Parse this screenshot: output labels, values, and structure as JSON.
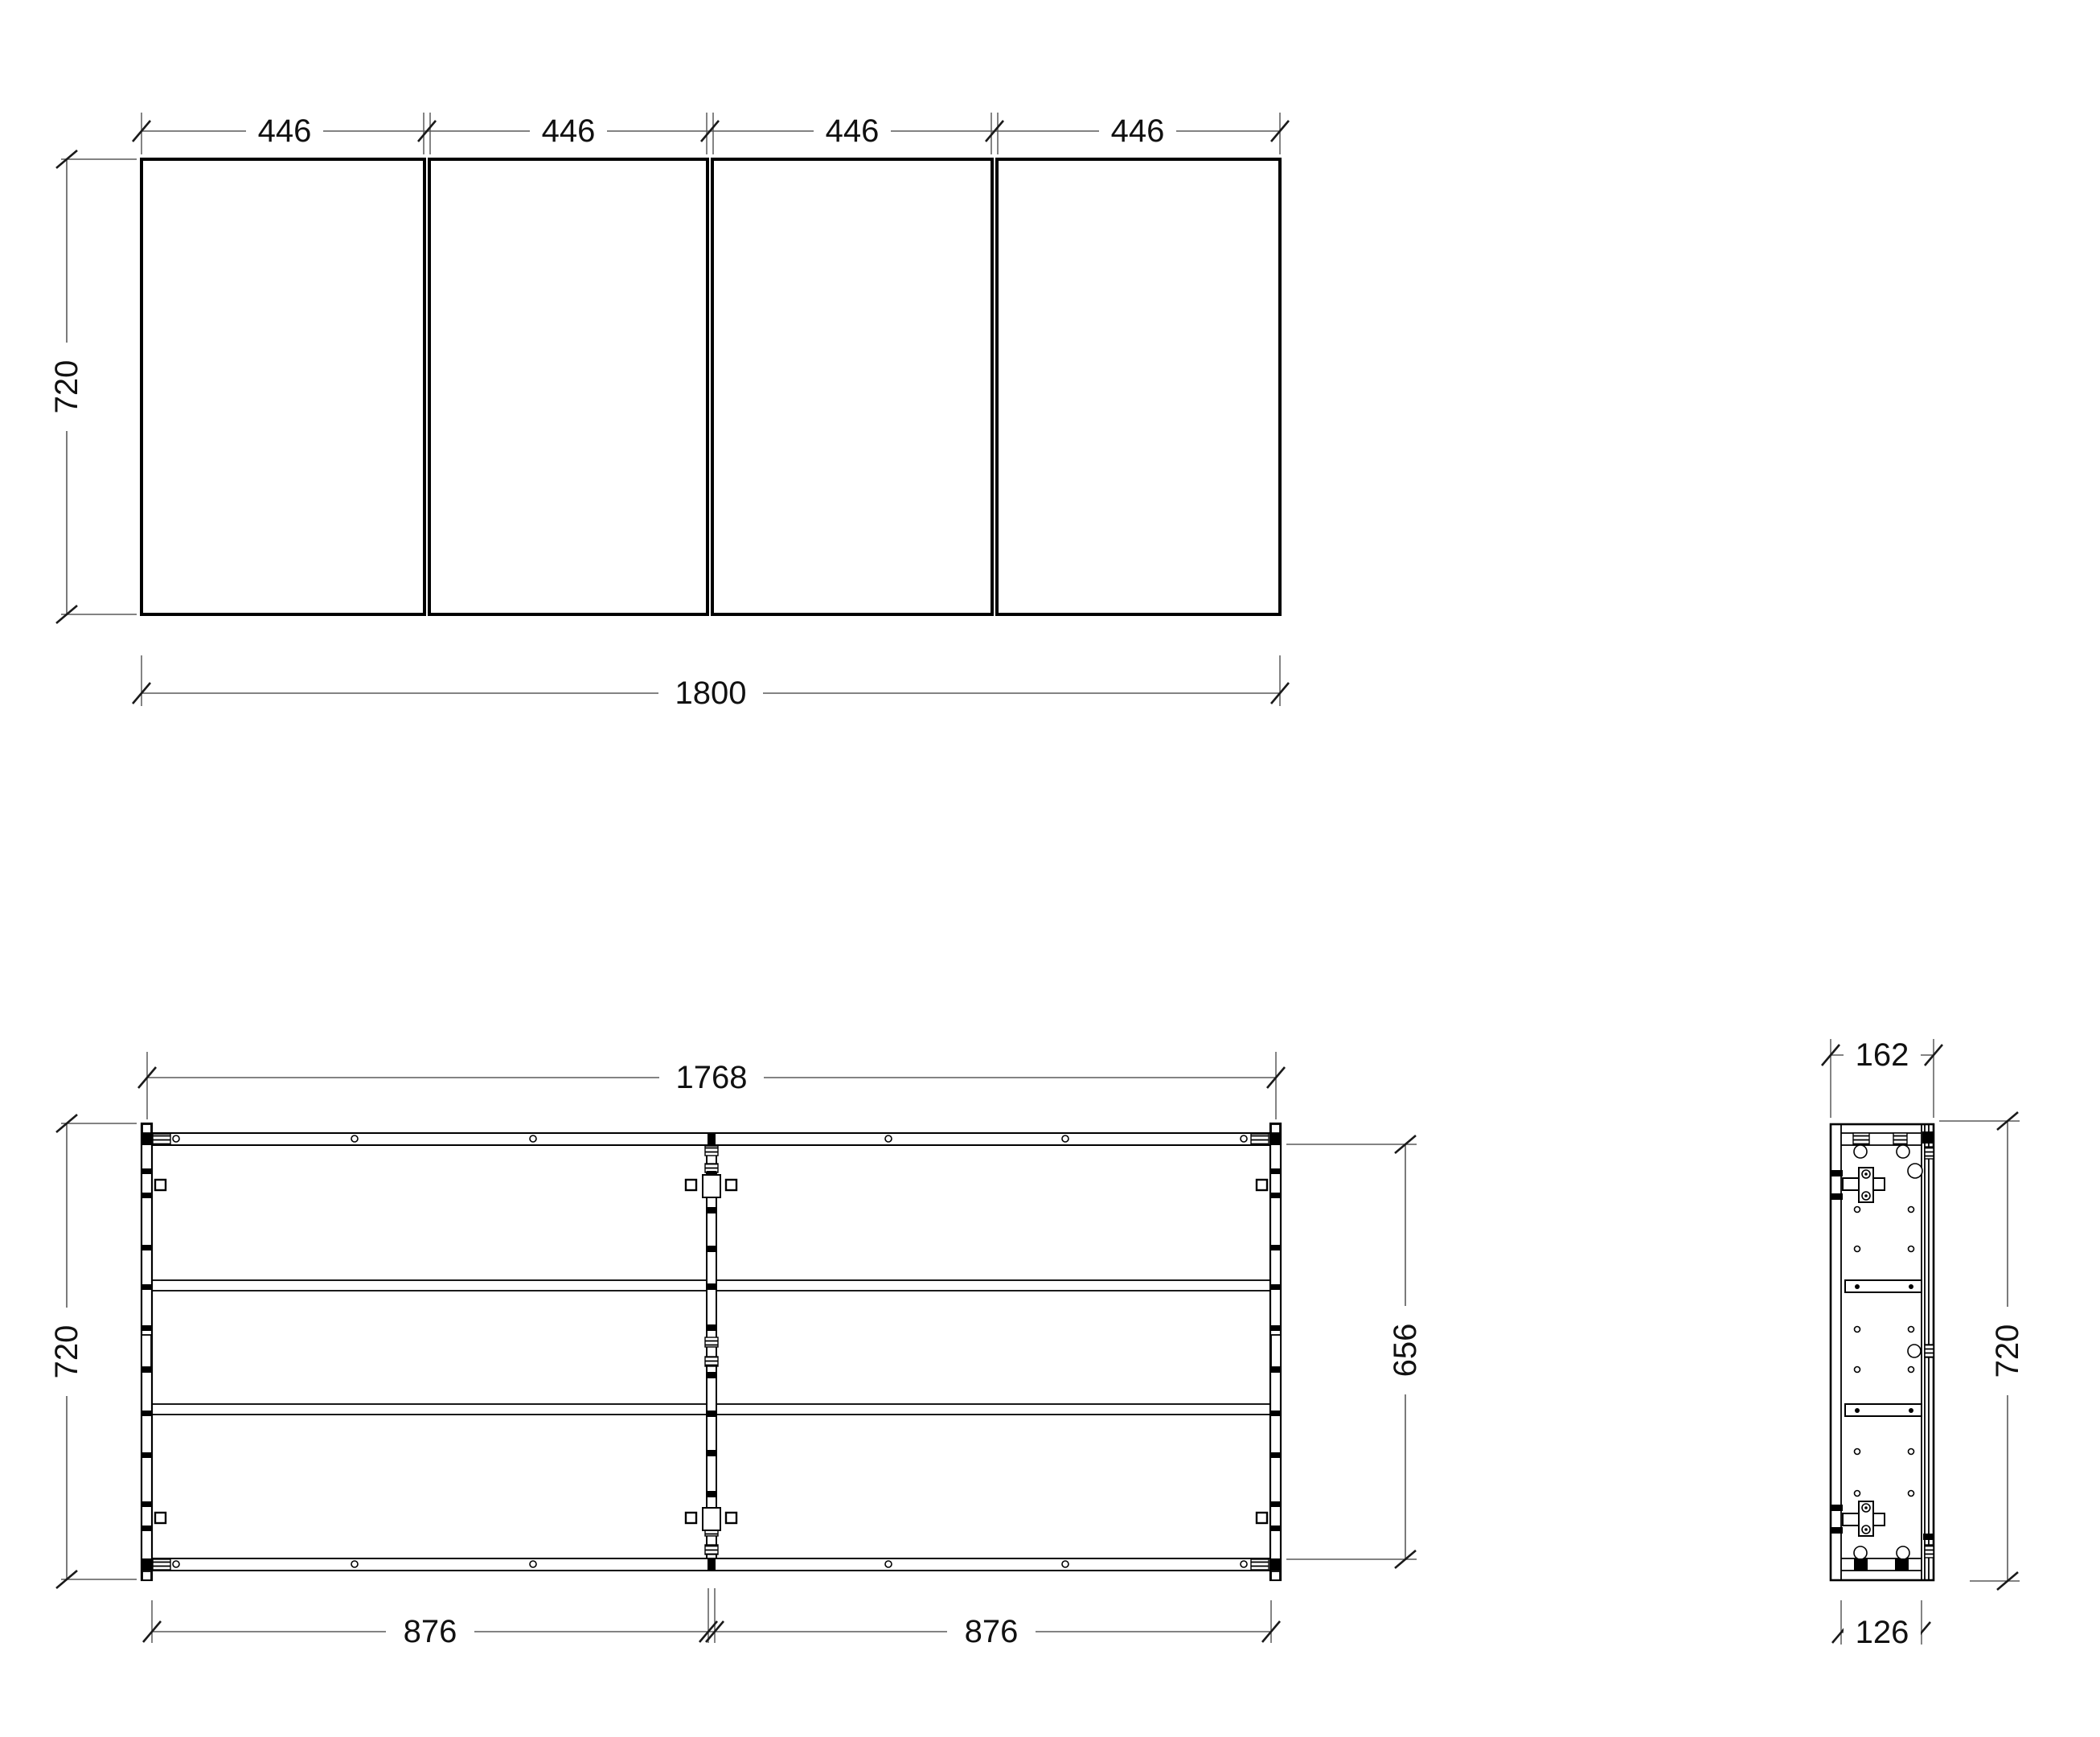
{
  "views": {
    "front": {
      "door_widths": [
        "446",
        "446",
        "446",
        "446"
      ],
      "height": "720",
      "total_width": "1800"
    },
    "carcass": {
      "width": "1768",
      "height": "720",
      "interior_height": "656",
      "compartment_widths": [
        "876",
        "876"
      ]
    },
    "side": {
      "depth": "162",
      "height": "720",
      "body_depth": "126"
    }
  }
}
